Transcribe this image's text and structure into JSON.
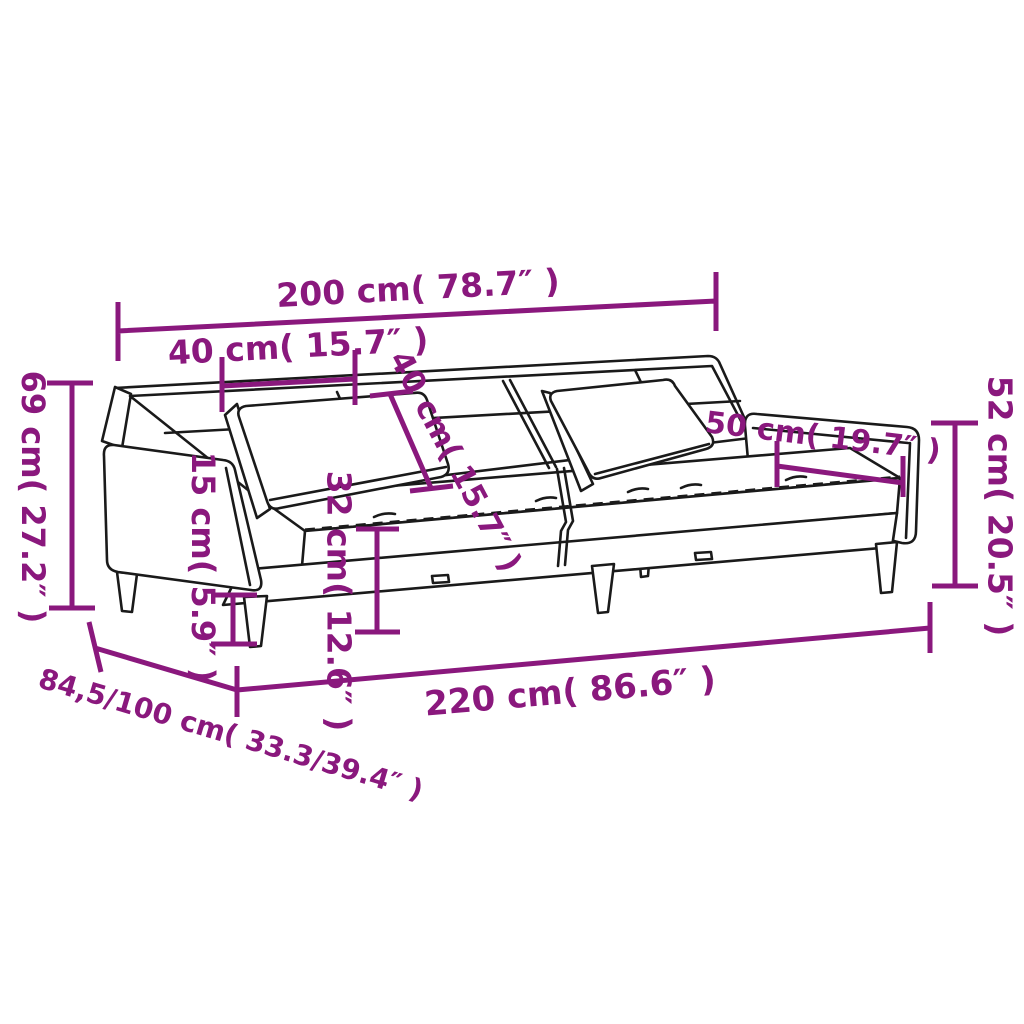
{
  "diagram": {
    "kind": "product-dimension-diagram",
    "product": "2-seater sofa bed with two pillows and armrests",
    "background": "#ffffff",
    "accent_color": "#8a187d",
    "line_color": "#1a1a1a"
  },
  "dimensions": [
    {
      "id": "top-width",
      "label": "200 cm( 78.7″ )"
    },
    {
      "id": "backrest-top-depth",
      "label": "40 cm( 15.7″ )"
    },
    {
      "id": "backrest-diagonal",
      "label": "40 cm( 15.7″ )"
    },
    {
      "id": "overall-height",
      "label": "69 cm( 27.2″ )"
    },
    {
      "id": "leg-height",
      "label": "15 cm( 5.9″ )"
    },
    {
      "id": "seat-height",
      "label": "32 cm( 12.6″ )"
    },
    {
      "id": "armrest-length",
      "label": "50 cm( 19.7″ )"
    },
    {
      "id": "armrest-height",
      "label": "52 cm( 20.5″ )"
    },
    {
      "id": "overall-length",
      "label": "220 cm( 86.6″ )"
    },
    {
      "id": "bed-depth",
      "label": "84,5/100 cm( 33.3/39.4″ )"
    }
  ]
}
